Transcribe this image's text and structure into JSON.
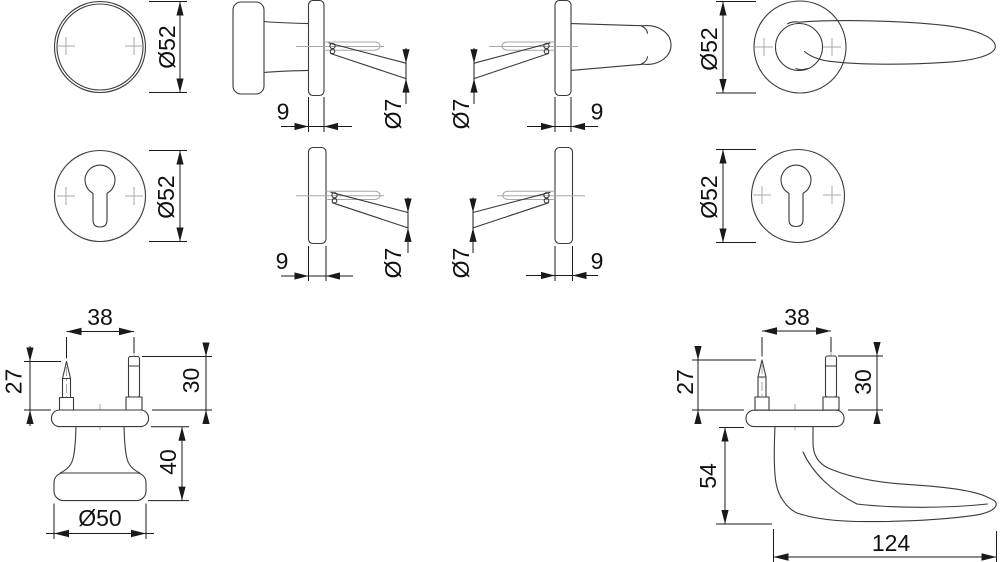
{
  "drawing": {
    "kind": "door-hardware-dimension-drawing",
    "background": "#ffffff",
    "line_color": "#3a3a3a",
    "dim_color": "#1a1a1a",
    "aux_color": "#a8a8a8",
    "views": {
      "knob_rose_front": {
        "name": "knob rose front view",
        "dia": "Ø52"
      },
      "knob_side": {
        "name": "knob side view",
        "rose_thickness": "9",
        "spindle_dia": "Ø7"
      },
      "lever_side": {
        "name": "lever side view",
        "rose_thickness": "9",
        "spindle_dia": "Ø7"
      },
      "lever_front": {
        "name": "lever front view",
        "dia": "Ø52"
      },
      "cyl_rose_front_left": {
        "name": "cylinder escutcheon front view left",
        "dia": "Ø52"
      },
      "cyl_rose_side_left": {
        "name": "cylinder escutcheon side view left",
        "rose_thickness": "9",
        "screw_dia": "Ø7"
      },
      "cyl_rose_side_right": {
        "name": "cylinder escutcheon side view right",
        "rose_thickness": "9",
        "screw_dia": "Ø7"
      },
      "cyl_rose_front_right": {
        "name": "cylinder escutcheon front view right",
        "dia": "Ø52"
      },
      "knob_elevation": {
        "name": "knob elevation",
        "pin_spacing": "38",
        "left_pin_height": "27",
        "right_pin_height": "30",
        "knob_height": "40",
        "knob_dia": "Ø50"
      },
      "lever_elevation": {
        "name": "lever elevation",
        "pin_spacing": "38",
        "left_pin_height": "27",
        "right_pin_height": "30",
        "handle_drop": "54",
        "handle_length": "124"
      }
    }
  }
}
